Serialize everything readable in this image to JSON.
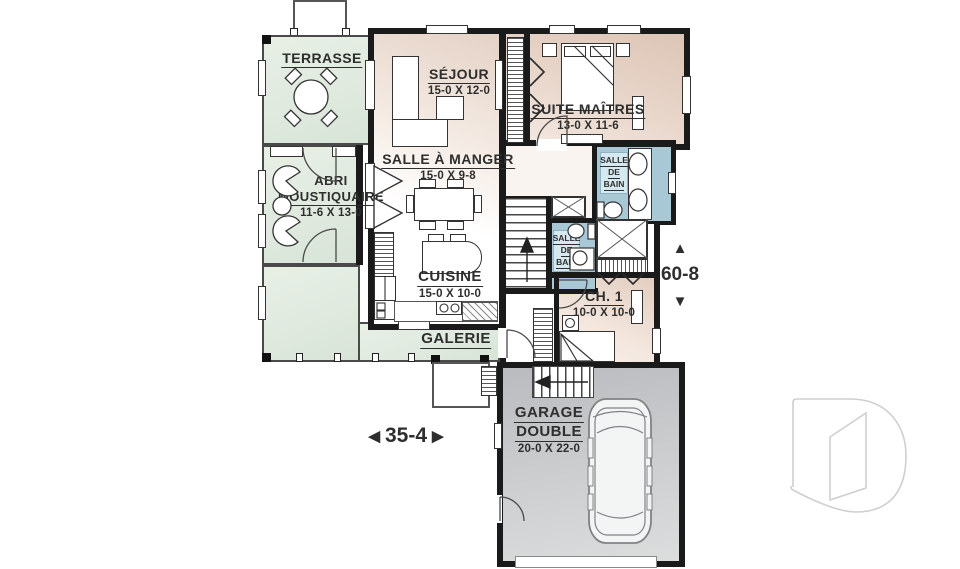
{
  "colors": {
    "porch_green": "#dfe9de",
    "room_tan": "#dcc5b6",
    "bath_blue": "#a9c8d6",
    "garage_gray": "#c3c5c7",
    "wall_black": "#1a1a1a",
    "text": "#2e2e2e"
  },
  "rooms": {
    "terrasse": {
      "name": "TERRASSE"
    },
    "sejour": {
      "name": "SÉJOUR",
      "dims": "15-0 X 12-0"
    },
    "suite_maitres": {
      "name": "SUITE MAÎTRES",
      "dims": "13-0 X 11-6"
    },
    "abri_moustiquaire": {
      "name_line1": "ABRI",
      "name_line2": "MOUSTIQUAIRE",
      "dims": "11-6 X 13-0"
    },
    "salle_a_manger": {
      "name": "SALLE À MANGER",
      "dims": "15-0 X 9-8"
    },
    "salle_de_bain_maitres": {
      "line1": "SALLE",
      "line2": "DE",
      "line3": "BAIN"
    },
    "salle_de_bain_hall": {
      "line1": "SALLE",
      "line2": "DE",
      "line3": "BAIN"
    },
    "cuisine": {
      "name": "CUISINE",
      "dims": "15-0 X 10-0"
    },
    "chambre1": {
      "name": "CH. 1",
      "dims": "10-0 X 10-0"
    },
    "galerie": {
      "name": "GALERIE"
    },
    "garage": {
      "name_line1": "GARAGE",
      "name_line2": "DOUBLE",
      "dims": "20-0 X 22-0"
    }
  },
  "dimensions": {
    "width": {
      "value": "35-4",
      "arrow_left": "◀",
      "arrow_right": "▶"
    },
    "height": {
      "value": "60-8",
      "arrow_up": "▲",
      "arrow_down": "▼"
    }
  },
  "watermark": {
    "name": "drummond-d-logo"
  }
}
